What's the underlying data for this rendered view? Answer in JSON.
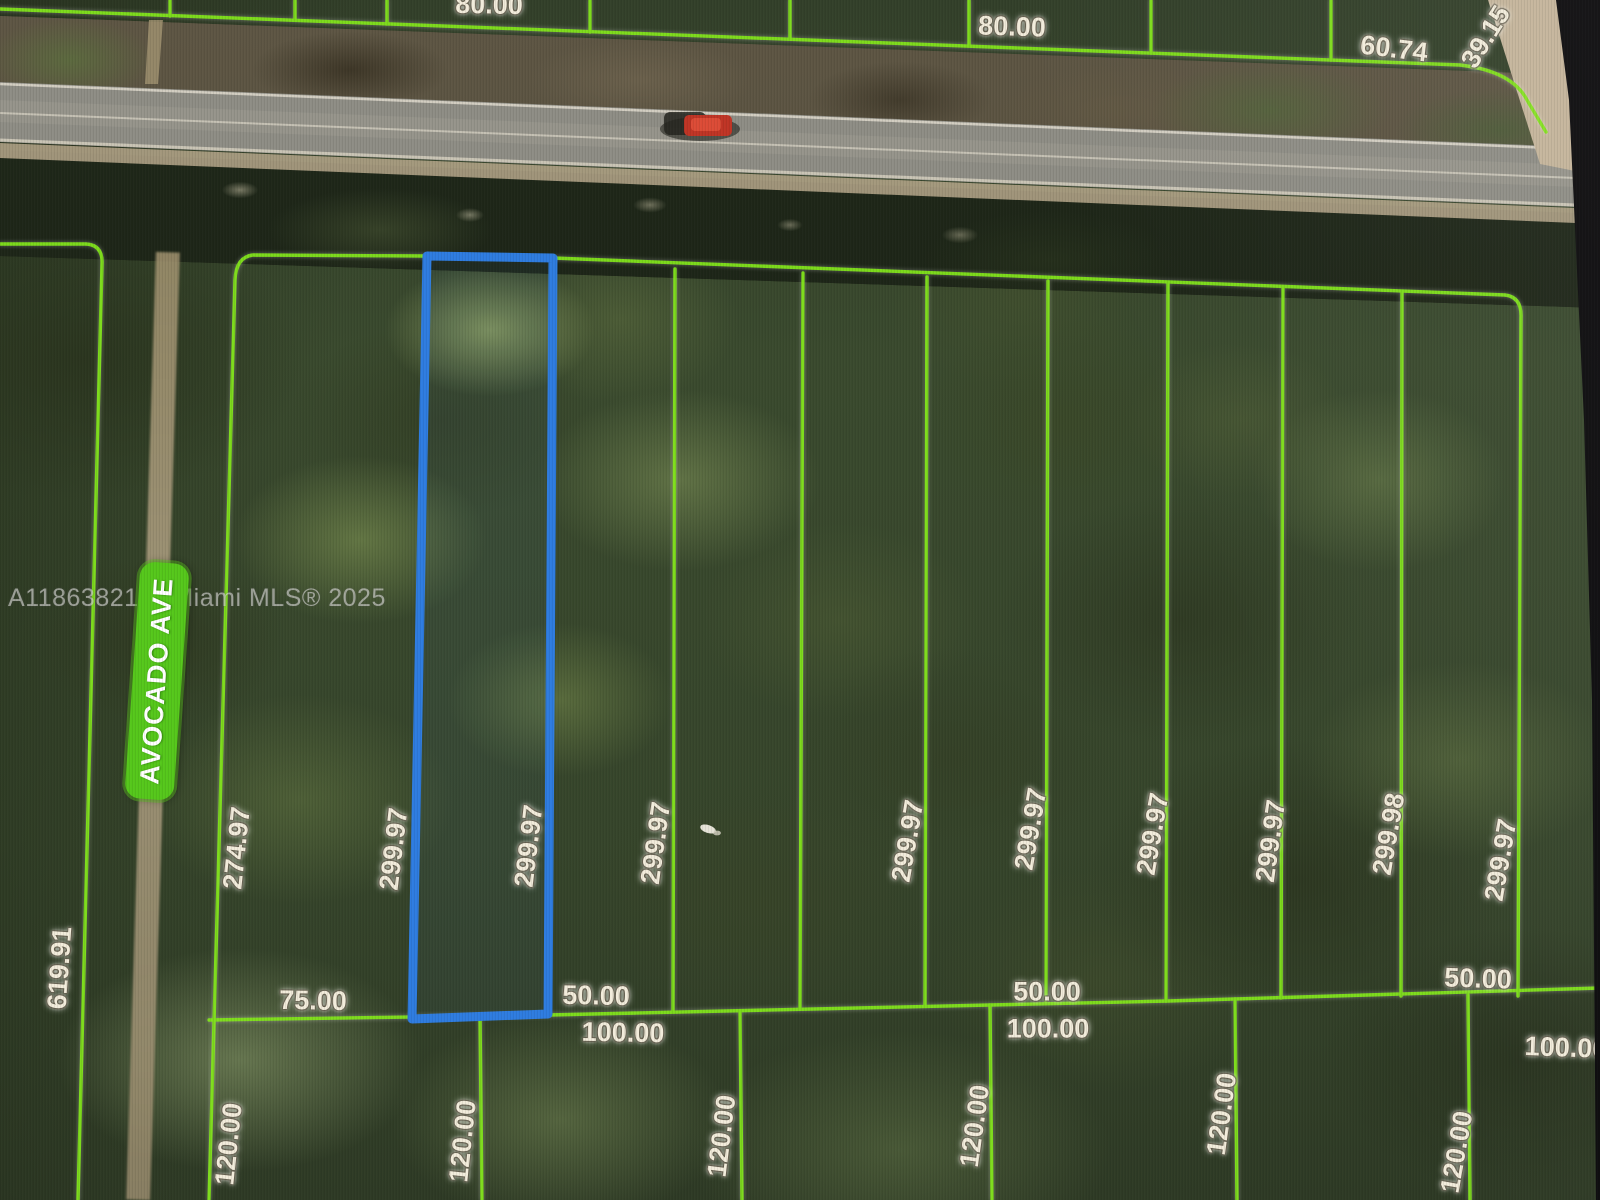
{
  "map": {
    "description": "Aerial parcel map photo with lot boundary overlay",
    "watermark": "A11863821 © Miami MLS® 2025",
    "street": {
      "name": "AVOCADO AVE"
    },
    "colors": {
      "parcel_line": "#82e41c",
      "selected_outline": "#2e7ce0",
      "street_pill": "#55c71b",
      "label_text": "#f2ecdb"
    },
    "selected_parcel": {
      "frontage": "50.00",
      "depth": "299.97"
    },
    "dims": {
      "d80": "80.00",
      "d6074": "60.74",
      "d3915": "39.15",
      "d27497": "274.97",
      "d61991": "619.91",
      "d29997": "299.97",
      "d29998": "299.98",
      "d7500": "75.00",
      "d5000": "50.00",
      "d10000": "100.00",
      "d12000": "120.00"
    }
  }
}
